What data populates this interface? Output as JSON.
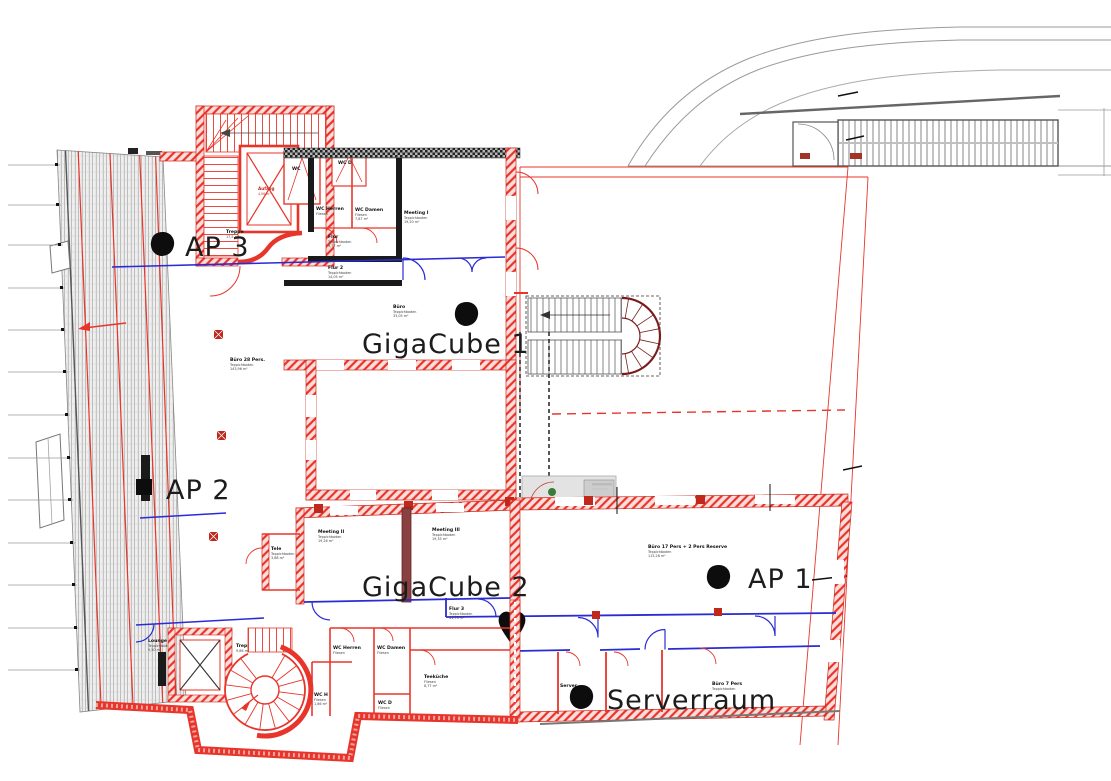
{
  "drawing_type": "floor-plan",
  "colors": {
    "wall_red": "#e8352b",
    "column_red": "#c0281c",
    "partition_blue": "#2b2bd4",
    "stair_maroon": "#7a1c1c",
    "wall_black": "#1a1a1a",
    "exterior_gray": "#8a8a8a",
    "marker_black": "#0d0d0d"
  },
  "labels": {
    "ap1": "AP 1",
    "ap2": "AP 2",
    "ap3": "AP 3",
    "gigacube1": "GigaCube 1",
    "gigacube2": "GigaCube 2",
    "serverraum": "Serverraum"
  },
  "rooms": {
    "treppe_top": {
      "name": "Treppe",
      "line2": "17,5 m²"
    },
    "aufzug_top": {
      "name": "Aufzug",
      "line2": "4,06 m²"
    },
    "wc_top": {
      "name": "WC"
    },
    "wcd_top": {
      "name": "WC D"
    },
    "wc_herren_top": {
      "name": "WC Herren",
      "line2": "Fliesen"
    },
    "wc_damen_top": {
      "name": "WC Damen",
      "line2": "Fliesen",
      "line3": "7,87 m²"
    },
    "meeting1": {
      "name": "Meeting I",
      "line2": "Teppichboden",
      "line3": "19,20 m²"
    },
    "flur": {
      "name": "Flur",
      "line2": "Teppichboden",
      "line3": "9,77 m²"
    },
    "flur2": {
      "name": "Flur 2",
      "line2": "Teppichboden",
      "line3": "14,05 m²"
    },
    "buero": {
      "name": "Büro",
      "line2": "Teppichboden",
      "line3": "33,05 m²"
    },
    "buero28": {
      "name": "Büro 28 Pers.",
      "line2": "Teppichboden",
      "line3": "143,96 m²"
    },
    "meeting2": {
      "name": "Meeting II",
      "line2": "Teppichboden",
      "line3": "19,26 m²"
    },
    "meeting3": {
      "name": "Meeting III",
      "line2": "Teppichboden",
      "line3": "19,35 m²"
    },
    "tele": {
      "name": "Tele",
      "line2": "Teppichboden",
      "line3": "3,88 m²"
    },
    "flur3": {
      "name": "Flur 3",
      "line2": "Teppichboden",
      "line3": "41,73 m²"
    },
    "buero17": {
      "name": "Büro 17 Pers + 2 Pers Reserve",
      "line2": "Teppichboden",
      "line3": "115,28 m²"
    },
    "lounge": {
      "name": "Lounge",
      "line2": "Teppichboden",
      "line3": "9,50 m²"
    },
    "treppe_bottom": {
      "name": "Treppe",
      "line2": "9,86 m²"
    },
    "wc_herren_bottom": {
      "name": "WC Herren",
      "line2": "Fliesen"
    },
    "wc_damen_bottom": {
      "name": "WC Damen",
      "line2": "Fliesen"
    },
    "wc_h": {
      "name": "WC H",
      "line2": "Fliesen",
      "line3": "1,86 m²"
    },
    "wc_d": {
      "name": "WC D",
      "line2": "Fliesen"
    },
    "teekueche": {
      "name": "Teeküche",
      "line2": "Fliesen",
      "line3": "8,77 m²"
    },
    "server": {
      "name": "Server"
    },
    "buero7": {
      "name": "Büro 7 Pers",
      "line2": "Teppichboden"
    }
  }
}
